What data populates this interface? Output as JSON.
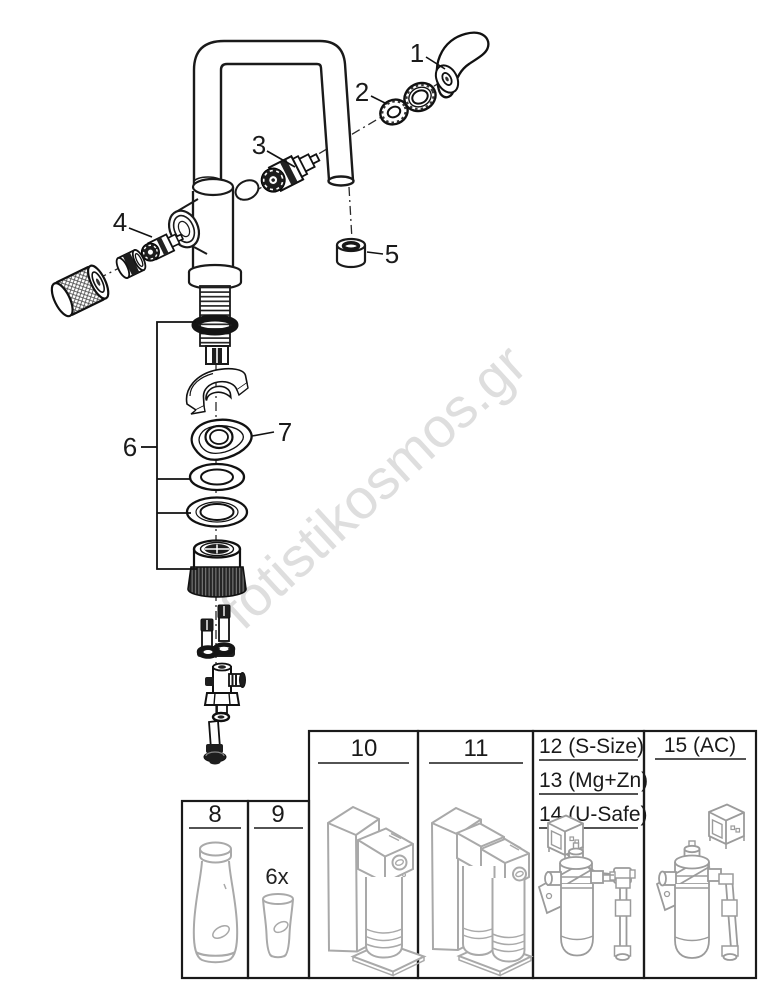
{
  "watermark": "fotistikosmos.gr",
  "colors": {
    "line": "#1a1a1a",
    "panel_border": "#1a1a1a",
    "panel_content_line": "#a9a9a9",
    "watermark": "#dedede",
    "background": "#ffffff"
  },
  "callouts": [
    "1",
    "2",
    "3",
    "4",
    "5",
    "6",
    "7"
  ],
  "panels": {
    "p8": {
      "label": "8"
    },
    "p9": {
      "label": "9",
      "quantity": "6x"
    },
    "p10": {
      "label": "10"
    },
    "p11": {
      "label": "11"
    },
    "p12_14": {
      "labels": [
        "12 (S-Size)",
        "13 (Mg+Zn)",
        "14 (U-Safe)"
      ]
    },
    "p15": {
      "label": "15 (AC)"
    }
  }
}
